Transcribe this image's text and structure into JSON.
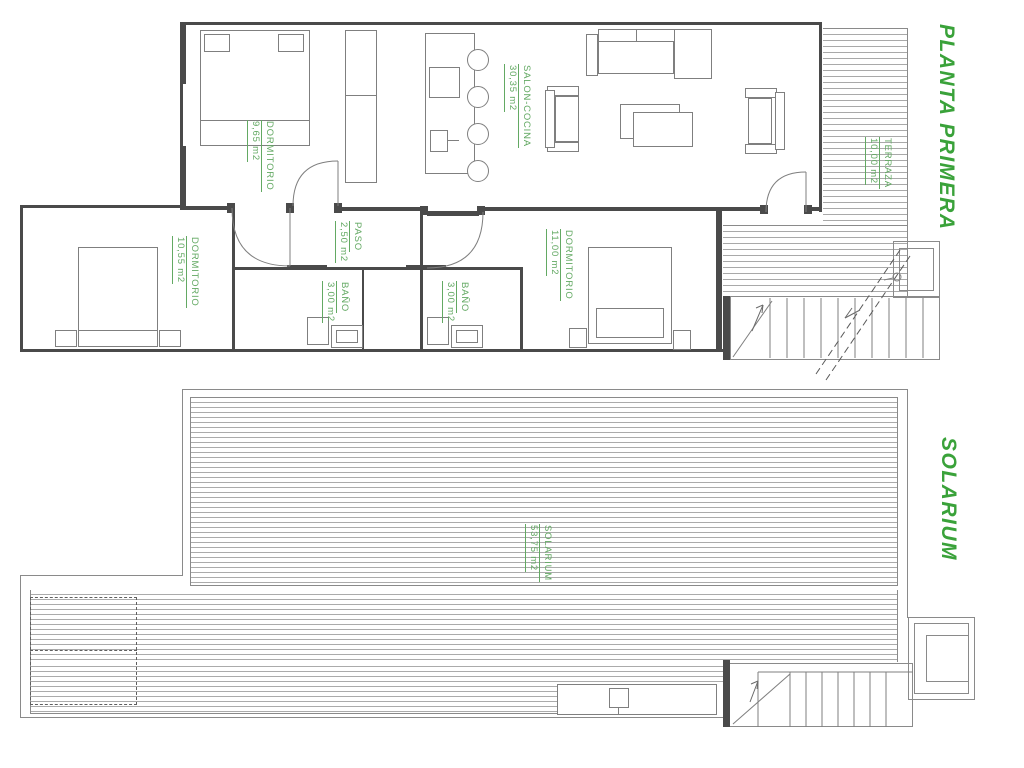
{
  "document": {
    "type": "architectural-floor-plan",
    "background": "#ffffff"
  },
  "colors": {
    "title_green": "#3aa23a",
    "label_green": "#63a963",
    "wall_dark": "#4a4a4a",
    "thin_line": "#8a8a8a",
    "deck_stripe": "#a9a9a9"
  },
  "plans": [
    {
      "title": "PLANTA PRIMERA",
      "rooms": [
        {
          "name": "DORMITORIO",
          "area": "9,65 m2"
        },
        {
          "name": "SALON-COCINA",
          "area": "30,35 m2"
        },
        {
          "name": "TERRAZA",
          "area": "10,00 m2"
        },
        {
          "name": "PASO",
          "area": "2,50 m2"
        },
        {
          "name": "DORMITORIO",
          "area": "10,55 m2"
        },
        {
          "name": "BAÑO",
          "area": "3,00 m2"
        },
        {
          "name": "BAÑO",
          "area": "3,00 m2"
        },
        {
          "name": "DORMITORIO",
          "area": "11,00 m2"
        }
      ]
    },
    {
      "title": "SOLARIUM",
      "rooms": [
        {
          "name": "SOLARIUM",
          "area": "53,75 m2"
        }
      ]
    }
  ]
}
